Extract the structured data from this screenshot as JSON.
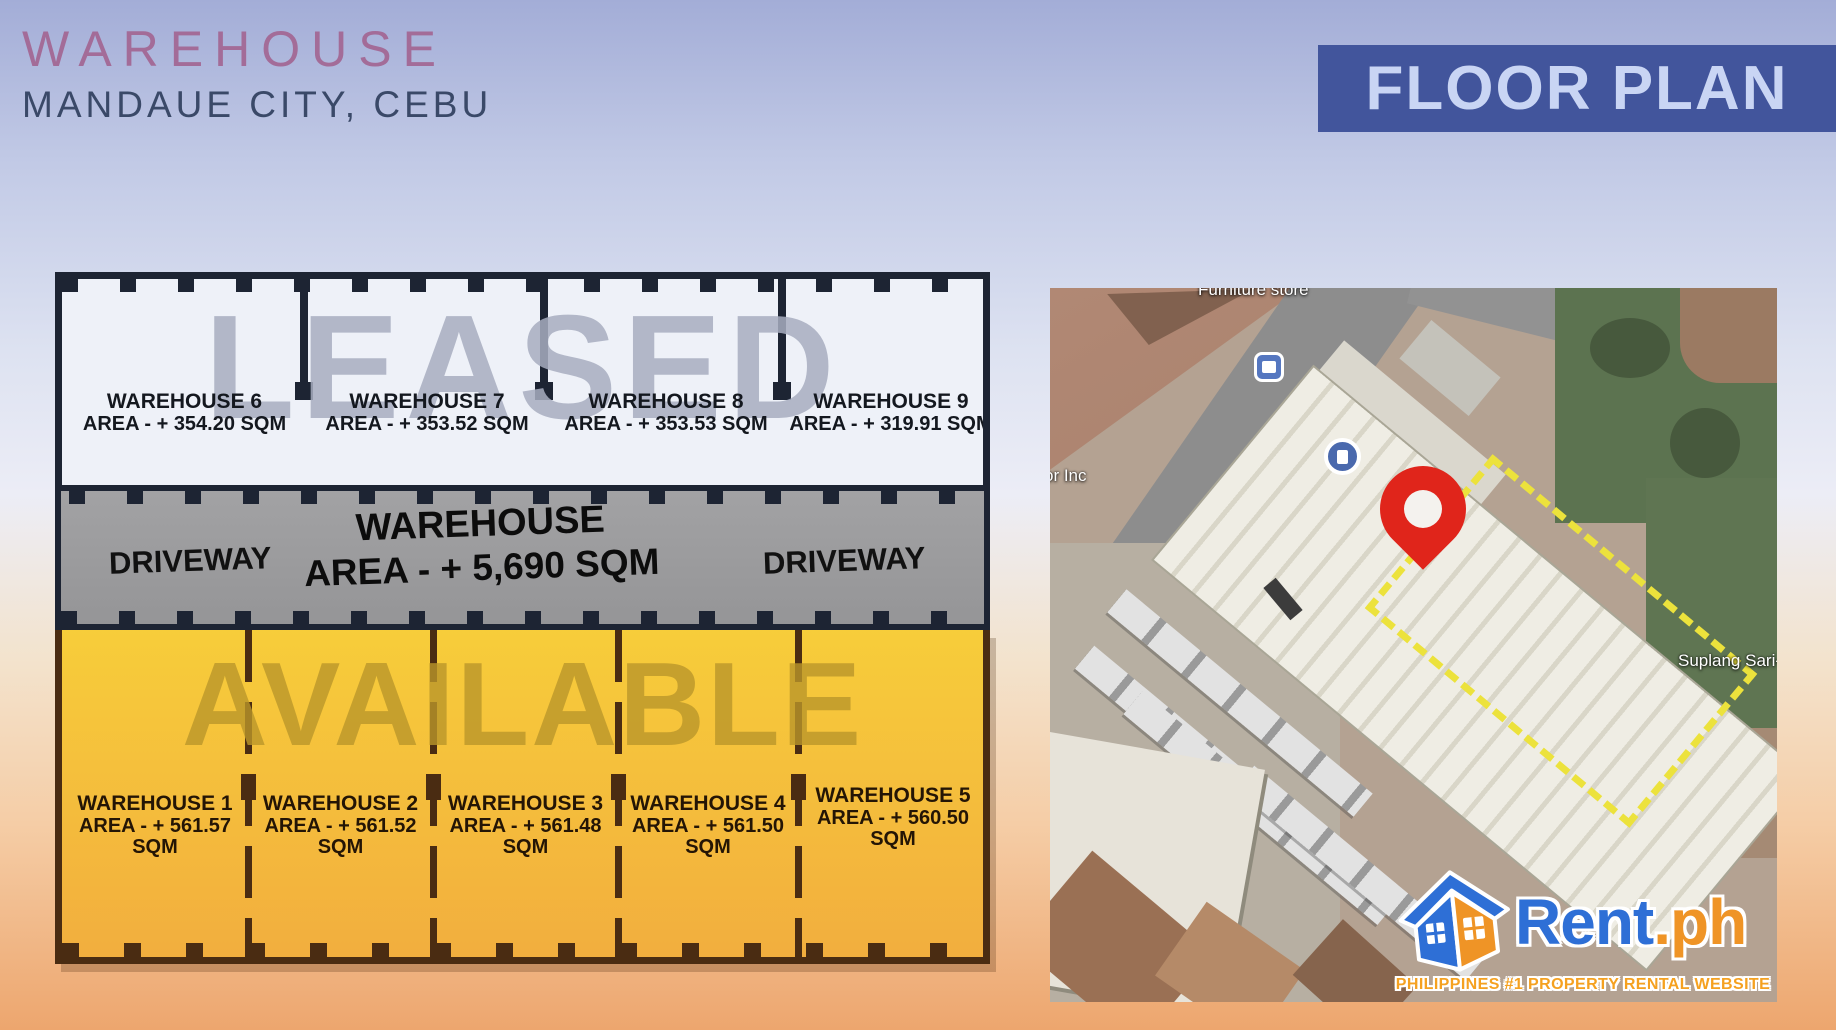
{
  "header": {
    "title": "WAREHOUSE",
    "subtitle": "MANDAUE CITY, CEBU",
    "banner": "FLOOR PLAN"
  },
  "floor_plan": {
    "leased_watermark": "LEASED",
    "available_watermark": "AVAILABLE",
    "driveway_left": "DRIVEWAY",
    "driveway_right": "DRIVEWAY",
    "central_warehouse": {
      "name": "WAREHOUSE",
      "area": "AREA - + 5,690 SQM"
    },
    "leased_units": [
      {
        "name": "WAREHOUSE 6",
        "area": "AREA - + 354.20 SQM"
      },
      {
        "name": "WAREHOUSE 7",
        "area": "AREA - + 353.52 SQM"
      },
      {
        "name": "WAREHOUSE 8",
        "area": "AREA - + 353.53 SQM"
      },
      {
        "name": "WAREHOUSE 9",
        "area": "AREA - + 319.91 SQM"
      }
    ],
    "available_units": [
      {
        "name": "WAREHOUSE 1",
        "area": "AREA - + 561.57 SQM"
      },
      {
        "name": "WAREHOUSE 2",
        "area": "AREA - + 561.52 SQM"
      },
      {
        "name": "WAREHOUSE 3",
        "area": "AREA - + 561.48 SQM"
      },
      {
        "name": "WAREHOUSE 4",
        "area": "AREA - + 561.50 SQM"
      },
      {
        "name": "WAREHOUSE 5",
        "area": "AREA - + 560.50 SQM"
      }
    ]
  },
  "map": {
    "labels": {
      "furniture_store": "Furniture store",
      "or_inc": "or Inc",
      "sari_store": "Suplang Sari-S"
    },
    "icons": [
      "bus-stop-icon",
      "gas-station-icon",
      "location-pin-icon"
    ],
    "highlight_outline_color": "#ece23c",
    "pin_color": "#e0251b"
  },
  "logo": {
    "brand_rent": "Rent",
    "brand_ph": ".ph",
    "tagline": "PHILIPPINES #1 PROPERTY RENTAL WEBSITE"
  },
  "colors": {
    "title": "#a36c98",
    "subtitle": "#3a4968",
    "banner_bg": "#42559c",
    "banner_text": "#c9d5f4",
    "leased_section": "#eef1f8",
    "driveway_gray": "#9c9c9e",
    "available_yellow": "#f6c93b",
    "wall_dark": "#1d2433",
    "wall_brown": "#4a2c12",
    "rent_blue": "#2e6fd6",
    "rent_orange": "#ef9426"
  }
}
